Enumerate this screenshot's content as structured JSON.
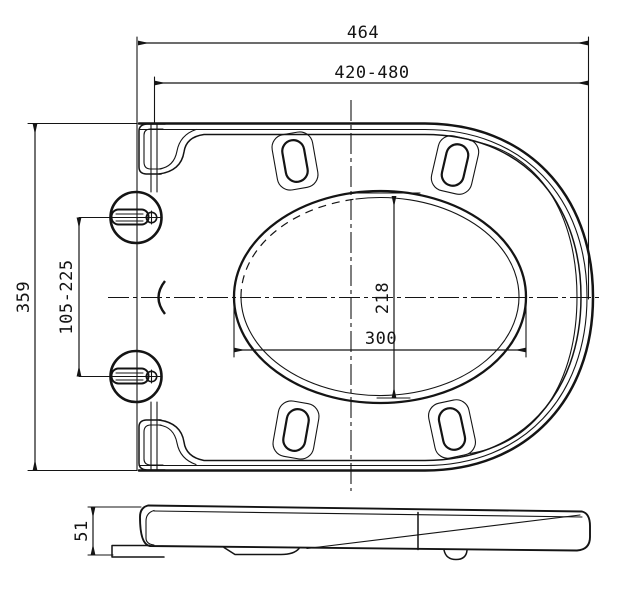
{
  "drawing": {
    "background": "#ffffff",
    "line_color": "#141414",
    "top_view": {
      "dimensions": {
        "overall_length": "464",
        "fit_length_range": "420-480",
        "overall_width": "359",
        "hinge_hole_range": "105-225",
        "opening_minor": "218",
        "opening_major": "300"
      }
    },
    "side_view": {
      "dimensions": {
        "seat_height": "51"
      }
    }
  }
}
